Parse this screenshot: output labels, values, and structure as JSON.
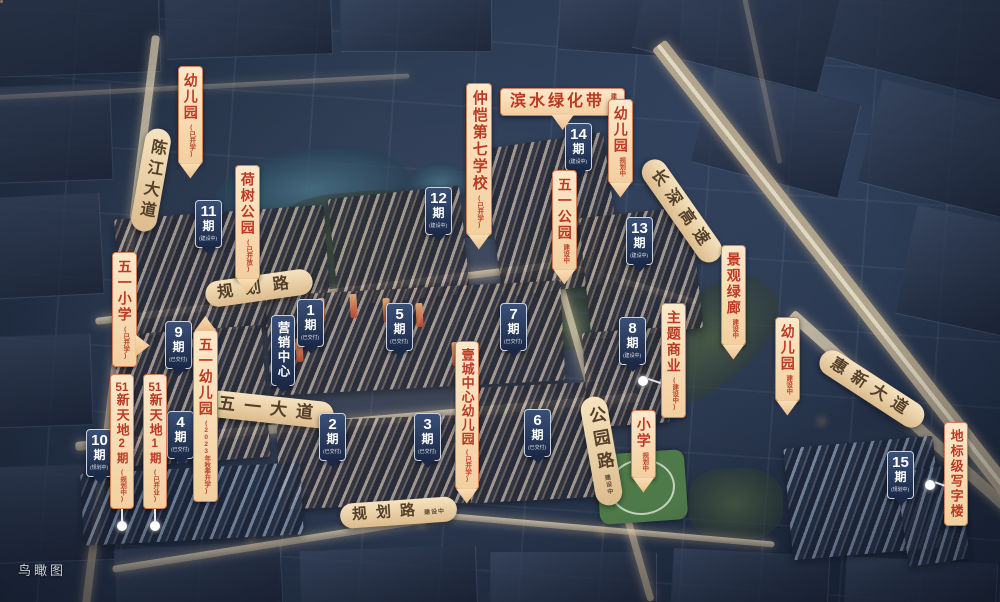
{
  "caption": "鸟瞰图",
  "phase_suffix": "期",
  "colors": {
    "accent_orange": "#bb3a24",
    "label_peach": "#fbe2c2",
    "flag_navy": "#1f2f52",
    "road_tan": "#e9cfa0"
  },
  "roads": {
    "chenjiang": {
      "name": "陈江大道"
    },
    "guihua_upper": {
      "name": "规划路"
    },
    "wuyi_avenue": {
      "name": "五一大道"
    },
    "gongyuan": {
      "name": "公园路",
      "status": "建设中"
    },
    "guihua_lower": {
      "name": "规划路",
      "status": "建设中"
    },
    "changshen": {
      "name": "长深高速"
    },
    "huixin": {
      "name": "惠新大道"
    }
  },
  "amenities": {
    "kindergarten_nw": {
      "name": "幼儿园",
      "status": "(已开学)"
    },
    "heshu_park": {
      "name": "荷树公园",
      "status": "(已开放)"
    },
    "wuyi_primary": {
      "name": "五一小学",
      "status": "(已开学)"
    },
    "zhongkai_no7_school": {
      "name": "仲恺第七学校",
      "status": "(已开学)"
    },
    "binshui_greenbelt": {
      "name": "滨水绿化带",
      "status": "建设中"
    },
    "kindergarten_n": {
      "name": "幼儿园",
      "status": "规划中"
    },
    "wuyi_park": {
      "name": "五一公园",
      "status": "建设中"
    },
    "jingguan_greenway": {
      "name": "景观绿廊",
      "status": "建设中"
    },
    "theme_commercial": {
      "name": "主题商业",
      "status": "(建设中)"
    },
    "kindergarten_e": {
      "name": "幼儿园",
      "status": "建设中"
    },
    "wuyi_kindergarten": {
      "name": "五一幼儿园",
      "status": "(2023年秋季开学)"
    },
    "xtd2": {
      "brand_num": "51",
      "brand": "新天地",
      "phase": "2期",
      "status": "(规划中)"
    },
    "xtd1": {
      "brand_num": "51",
      "brand": "新天地",
      "phase": "1期",
      "status": "(已开业)"
    },
    "yicheng_kindergarten": {
      "name": "壹城中心幼儿园",
      "status": "(已开学)"
    },
    "primary_planned": {
      "name": "小学",
      "status": "规划中"
    },
    "landmark_tower": {
      "name": "地标级写字楼"
    }
  },
  "marketing_center": {
    "name": "营销中心"
  },
  "phases": [
    {
      "num": "1",
      "status": "(已交付)"
    },
    {
      "num": "2",
      "status": "(已交付)"
    },
    {
      "num": "3",
      "status": "(已交付)"
    },
    {
      "num": "4",
      "status": "(已交付)"
    },
    {
      "num": "5",
      "status": "(已交付)"
    },
    {
      "num": "6",
      "status": "(已交付)"
    },
    {
      "num": "7",
      "status": "(已交付)"
    },
    {
      "num": "8",
      "status": "(建设中)"
    },
    {
      "num": "9",
      "status": "(已交付)"
    },
    {
      "num": "10",
      "status": "(规划中)"
    },
    {
      "num": "11",
      "status": "(建设中)"
    },
    {
      "num": "12",
      "status": "(建设中)"
    },
    {
      "num": "13",
      "status": "(建设中)"
    },
    {
      "num": "14",
      "status": "(建设中)"
    },
    {
      "num": "15",
      "status": "(规划中)"
    }
  ]
}
